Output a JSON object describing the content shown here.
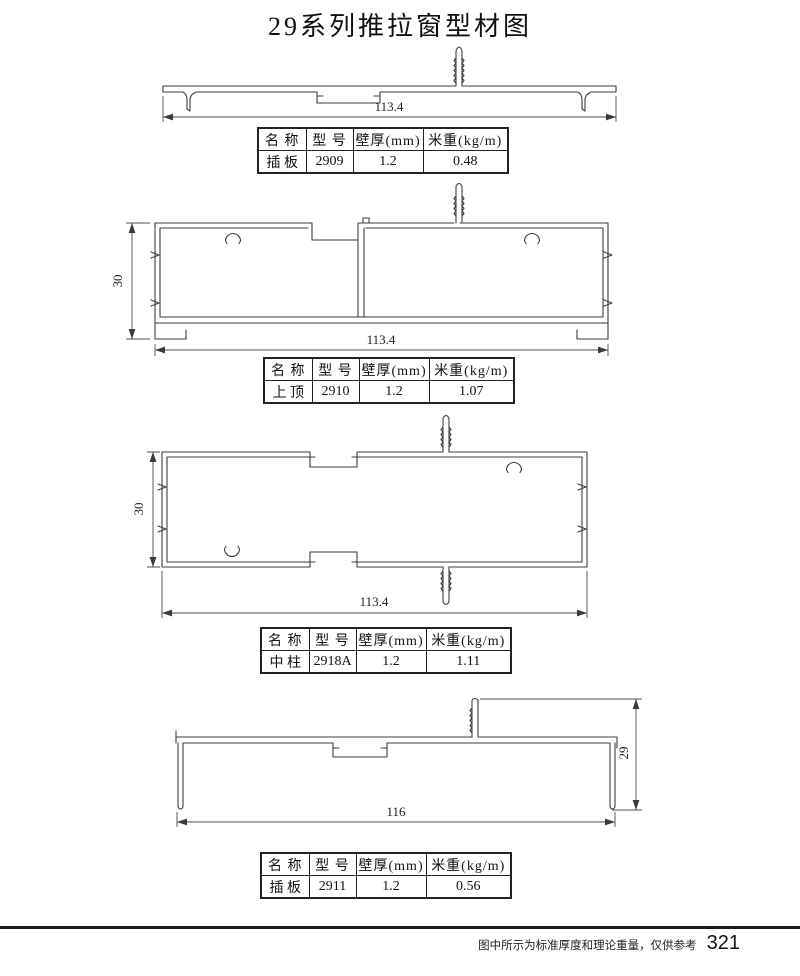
{
  "title": "29系列推拉窗型材图",
  "table_headers": {
    "name": "名 称",
    "model": "型 号",
    "thickness": "壁厚(mm)",
    "weight": "米重(kg/m)"
  },
  "profiles": [
    {
      "name": "插 板",
      "model": "2909",
      "thickness": "1.2",
      "weight": "0.48",
      "dim_width": "113.4"
    },
    {
      "name": "上 顶",
      "model": "2910",
      "thickness": "1.2",
      "weight": "1.07",
      "dim_width": "113.4",
      "dim_height": "30"
    },
    {
      "name": "中 柱",
      "model": "2918A",
      "thickness": "1.2",
      "weight": "1.11",
      "dim_width": "113.4",
      "dim_height": "30"
    },
    {
      "name": "插 板",
      "model": "2911",
      "thickness": "1.2",
      "weight": "0.56",
      "dim_width": "116",
      "dim_height": "29"
    }
  ],
  "footer": {
    "note": "图中所示为标准厚度和理论重量，仅供参考",
    "page_number": "321"
  }
}
